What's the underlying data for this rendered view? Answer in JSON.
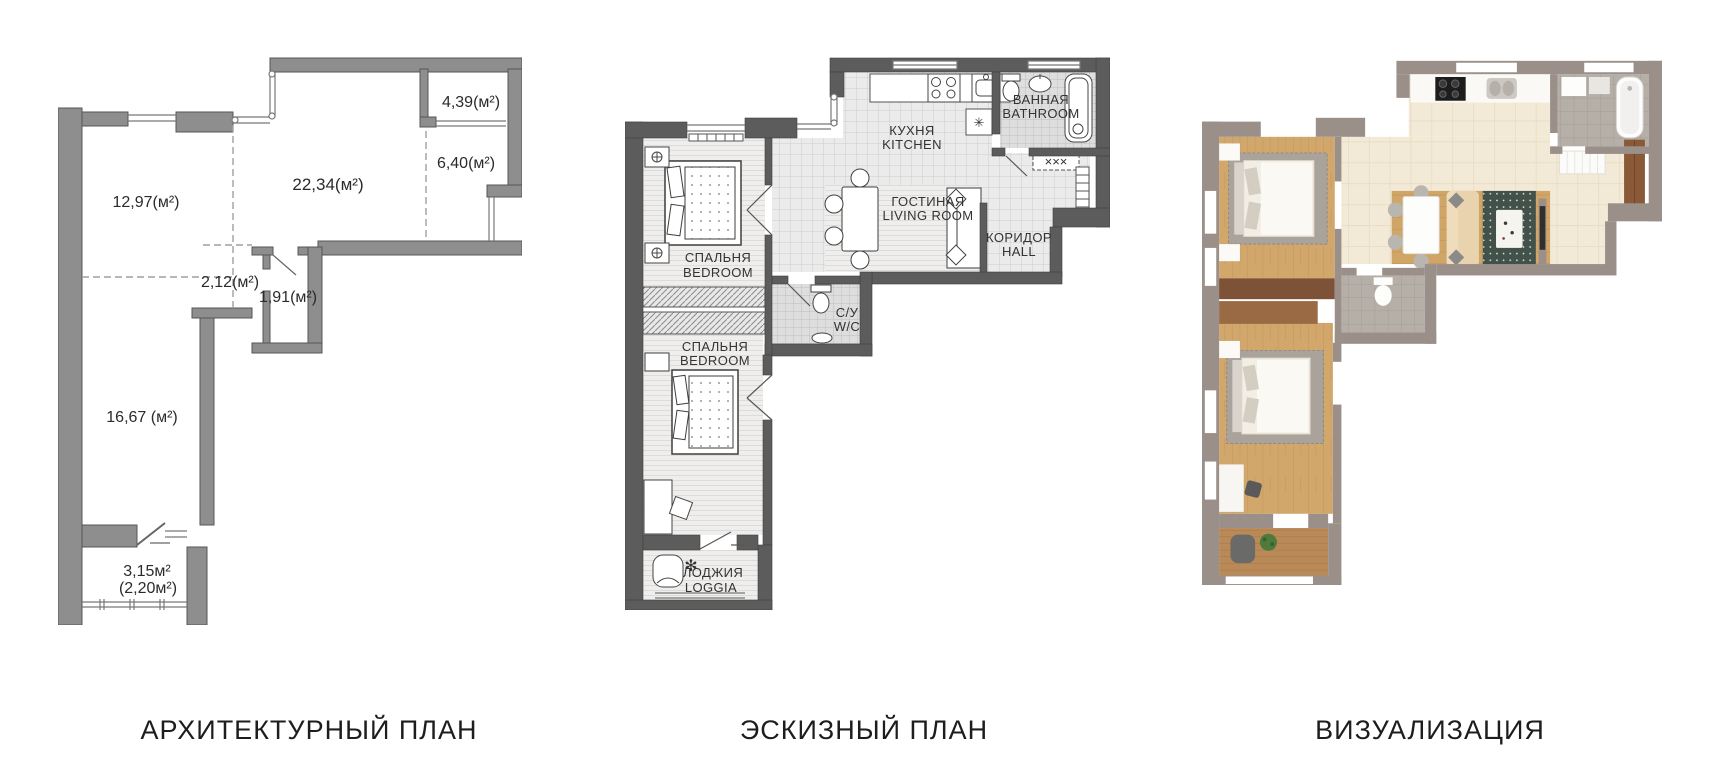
{
  "captions": {
    "architectural": "АРХИТЕКТУРНЫЙ ПЛАН",
    "sketch": "ЭСКИЗНЫЙ ПЛАН",
    "visualization": "ВИЗУАЛИЗАЦИЯ"
  },
  "architectural_plan": {
    "areas": {
      "room_left": "12,97(м²)",
      "living_large": "22,34(м²)",
      "balcony_top_right": "4,39(м²)",
      "room_right": "6,40(м²)",
      "hall_small": "2,12(м²)",
      "wc_small": "1,91(м²)",
      "room_bottom_left": "16,67 (м²)",
      "loggia_area": "3,15м²",
      "loggia_area_reduced": "(2,20м²)"
    }
  },
  "sketch_plan": {
    "rooms": {
      "kitchen": {
        "ru": "КУХНЯ",
        "en": "KITCHEN"
      },
      "bathroom": {
        "ru": "ВАННАЯ",
        "en": "BATHROOM"
      },
      "living_room": {
        "ru": "ГОСТИНАЯ",
        "en": "LIVING ROOM"
      },
      "hall": {
        "ru": "КОРИДОР",
        "en": "HALL"
      },
      "bedroom_1": {
        "ru": "СПАЛЬНЯ",
        "en": "BEDROOM"
      },
      "wc": {
        "ru": "С/У",
        "en": "W/C"
      },
      "bedroom_2": {
        "ru": "СПАЛЬНЯ",
        "en": "BEDROOM"
      },
      "loggia": {
        "ru": "ЛОДЖИЯ",
        "en": "LOGGIA"
      }
    },
    "symbols": {
      "closet_marks": "×××",
      "fridge_mark": "✳",
      "plant_mark": "✻"
    }
  },
  "colors": {
    "arch_wall": "#8e8e8e",
    "sketch_wall": "#5c5c5c",
    "viz_wall": "#9a9089",
    "viz_tile_cream": "#f2e9d6",
    "viz_wood": "#d2a76c",
    "viz_wood_loggia": "#b98a58",
    "viz_tile_gray": "#b5afa8",
    "viz_wardrobe_dark": "#7d5236",
    "viz_wardrobe_light": "#9a6a44",
    "viz_rug_green": "#42524a",
    "viz_sofa_tan": "#e8d3ae"
  }
}
